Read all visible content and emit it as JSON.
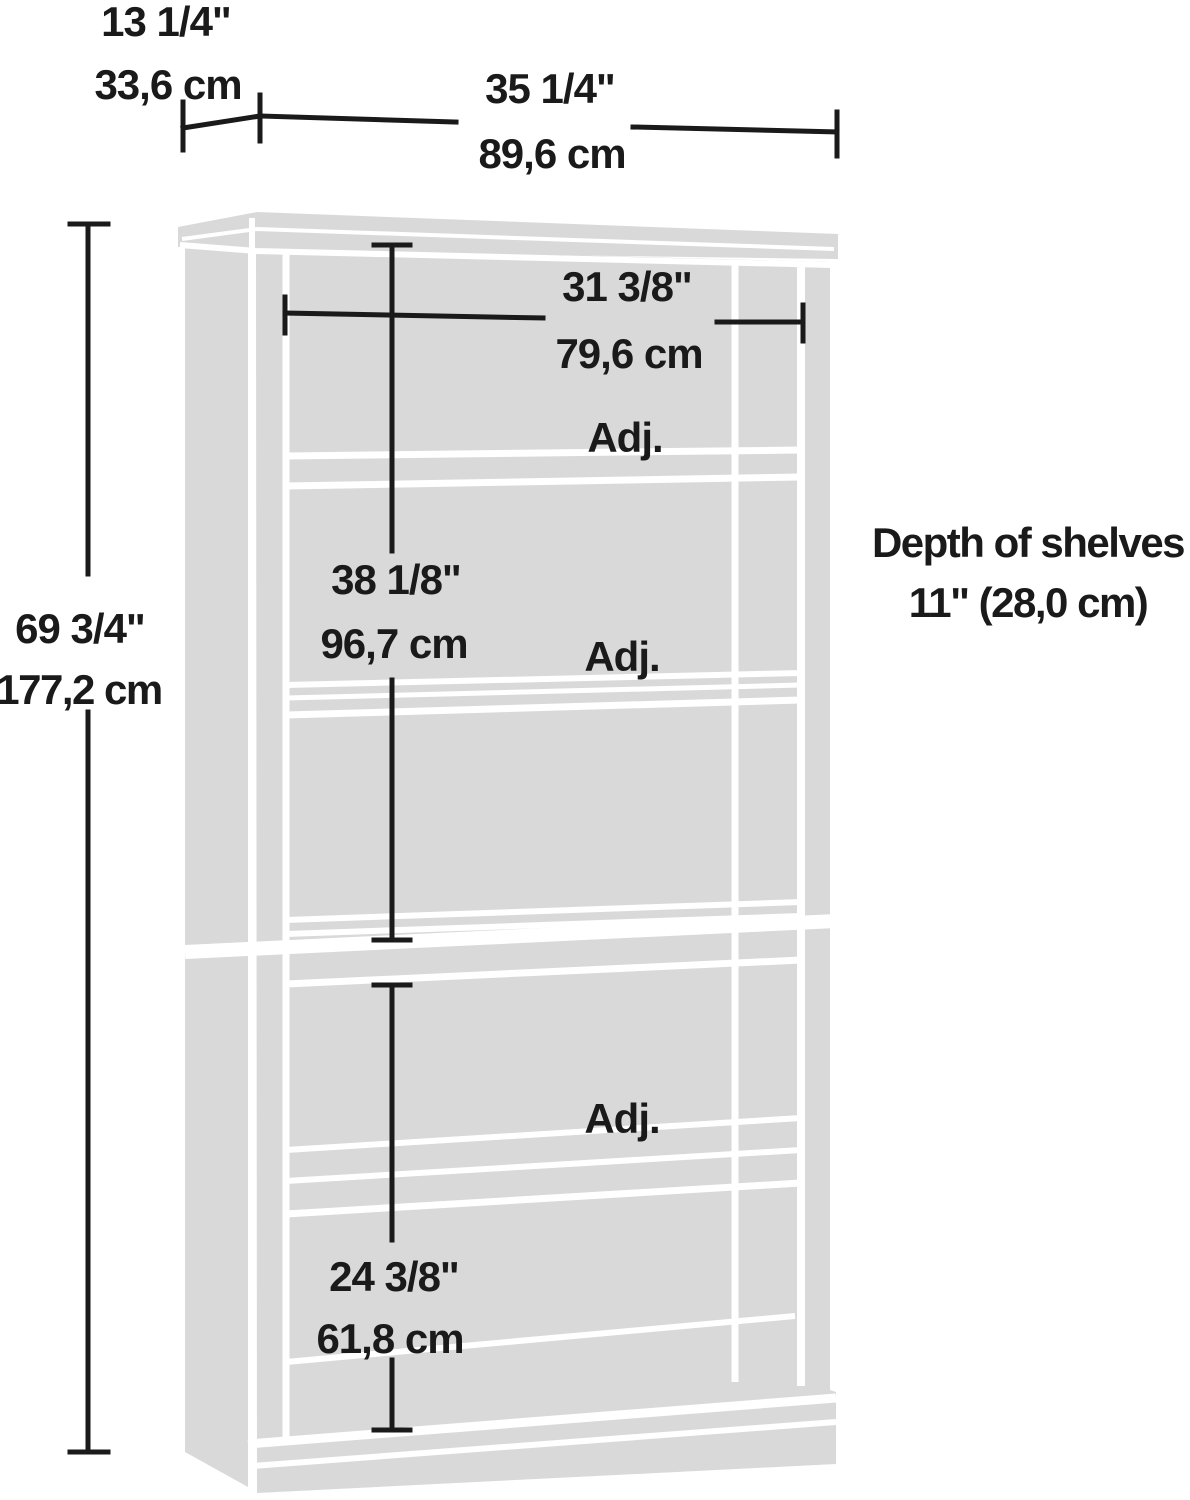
{
  "labels": {
    "depth_top": {
      "inches": "13 1/4\"",
      "cm": "33,6 cm"
    },
    "width_top": {
      "inches": "35 1/4\"",
      "cm": "89,6 cm"
    },
    "inner_width": {
      "inches": "31 3/8\"",
      "cm": "79,6 cm"
    },
    "height": {
      "inches": "69 3/4\"",
      "cm": "177,2 cm"
    },
    "upper_section": {
      "inches": "38 1/8\"",
      "cm": "96,7 cm"
    },
    "lower_section": {
      "inches": "24 3/8\"",
      "cm": "61,8 cm"
    },
    "shelf_depth": {
      "line1": "Depth of shelves",
      "line2": "11\" (28,0 cm)"
    },
    "adjustable_shelf": "Adj."
  },
  "colors": {
    "furniture": "#d9d9d9",
    "panel_gaps": "#ffffff",
    "dimension_lines": "#1a1a1a",
    "background": "#ffffff"
  }
}
